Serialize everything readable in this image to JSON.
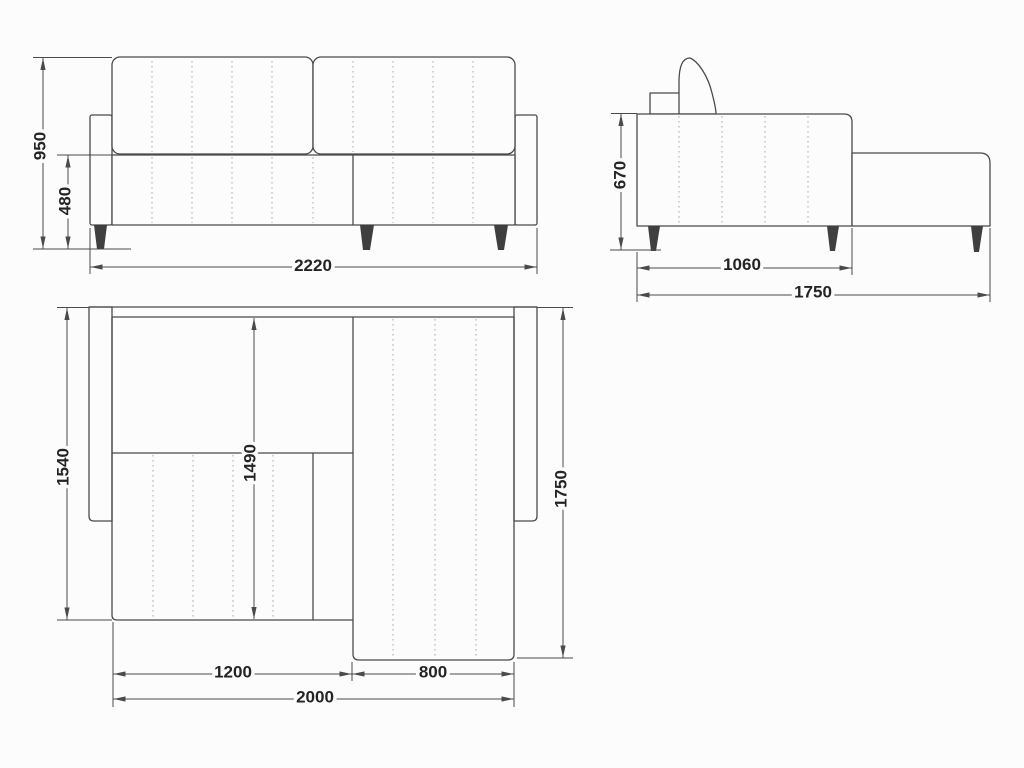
{
  "drawing": {
    "subject": "corner-sofa-with-chaise",
    "colors": {
      "background": "#fcfcfc",
      "outline": "#4a4a4a",
      "seam_dotted": "#adadad",
      "leg_fill": "#3f3f3f",
      "label_text": "#242424"
    },
    "views": {
      "front": {
        "dims": {
          "overall_height": "950",
          "seat_height": "480",
          "overall_width": "2220"
        }
      },
      "side": {
        "dims": {
          "body_height": "670",
          "body_depth": "1060",
          "overall_depth": "1750"
        }
      },
      "plan": {
        "dims": {
          "left_section_depth": "1540",
          "inner_depth": "1490",
          "chaise_depth": "1750",
          "left_section_width": "1200",
          "chaise_width": "800",
          "overall_width": "2000"
        }
      }
    }
  }
}
